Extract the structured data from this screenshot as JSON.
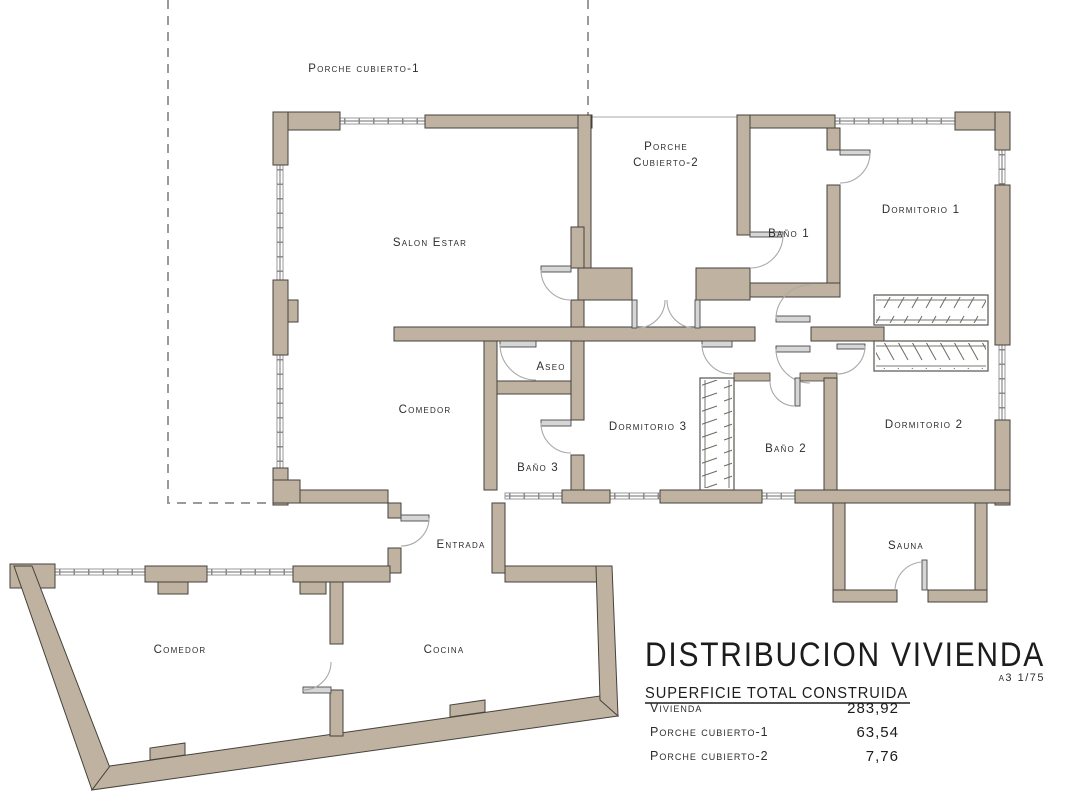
{
  "palette": {
    "wall_fill": "#bfb2a0",
    "wall_outline": "#45423c",
    "window_line": "#8a8a8a",
    "dashed_outline": "#9b9b9b",
    "text": "#2e2d2b"
  },
  "plan": {
    "rooms": {
      "porche1": "Porche cubierto-1",
      "salon": "Salon Estar",
      "porche2_line1": "Porche",
      "porche2_line2": "Cubierto-2",
      "bano1": "Baño 1",
      "dormitorio1": "Dormitorio 1",
      "aseo": "Aseo",
      "comedor_principal": "Comedor",
      "dormitorio3": "Dormitorio 3",
      "bano3": "Baño 3",
      "bano2": "Baño 2",
      "dormitorio2": "Dormitorio 2",
      "entrada": "Entrada",
      "sauna": "Sauna",
      "comedor_anexo": "Comedor",
      "cocina": "Cocina"
    }
  },
  "title_block": {
    "title": "DISTRIBUCION VIVIENDA",
    "sheet_scale": "a3 1/75",
    "table_heading": "SUPERFICIE TOTAL CONSTRUIDA",
    "rows": [
      {
        "label": "Vivienda",
        "value": "283,92"
      },
      {
        "label": "Porche cubierto-1",
        "value": "63,54"
      },
      {
        "label": "Porche cubierto-2",
        "value": "7,76"
      }
    ]
  }
}
